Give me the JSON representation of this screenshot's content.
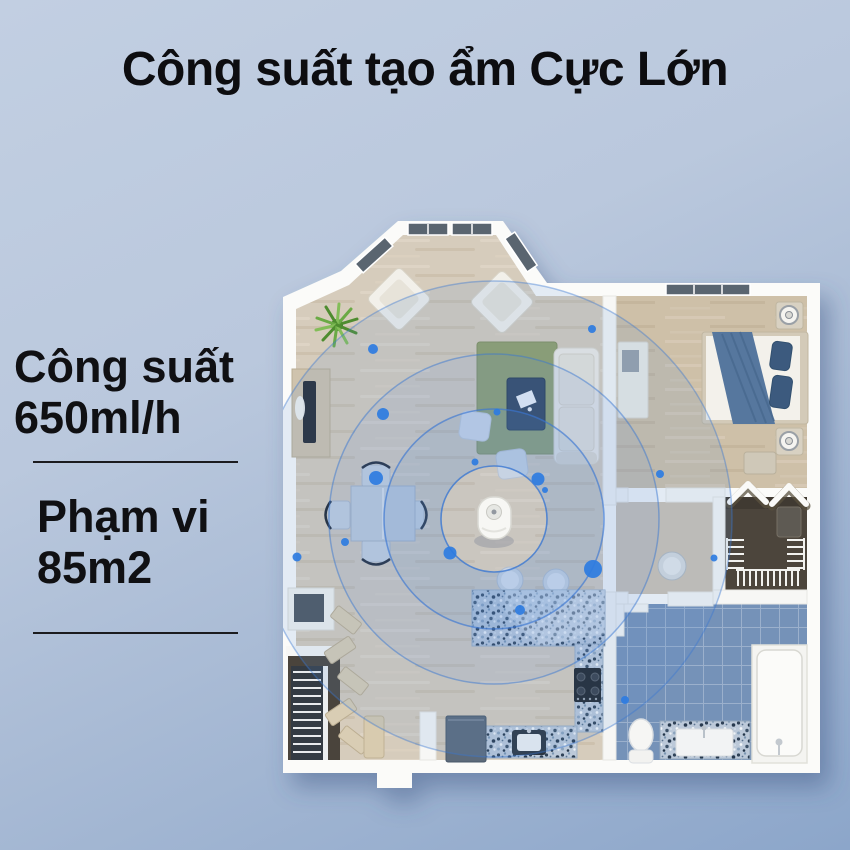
{
  "title": "Công suất tạo ẩm Cực Lớn",
  "specs": [
    {
      "label": "Công suất",
      "value": "650ml/h"
    },
    {
      "label": "Phạm vi",
      "value": "85m2"
    }
  ],
  "colors": {
    "background_top": "#c2cfe2",
    "background_bottom": "#8ca6ca",
    "text": "#0d0d10",
    "mist_ring": "#3a77d2",
    "mist_fill": "#5b8ed8",
    "mist_dot": "#2e7ce1"
  }
}
